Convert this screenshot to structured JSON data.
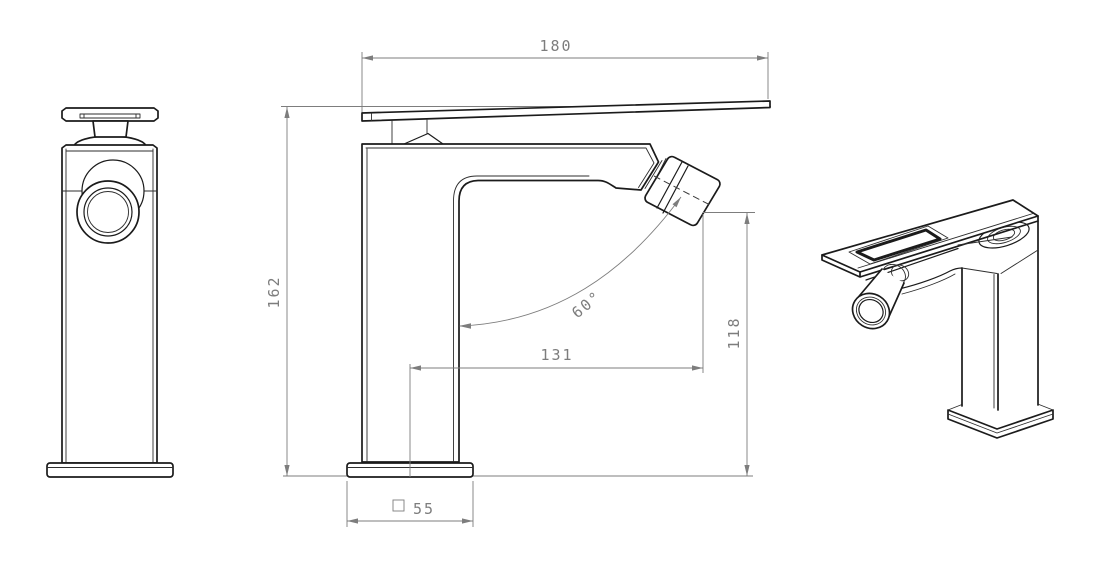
{
  "drawing": {
    "background": "#ffffff",
    "line_color": "#1b1b1b",
    "dimension_color": "#7d7d7d",
    "dimensions": {
      "handle_length": "180",
      "total_height": "162",
      "spout_reach": "131",
      "outlet_height": "118",
      "swivel_angle": "60°",
      "base_square": "55"
    }
  }
}
